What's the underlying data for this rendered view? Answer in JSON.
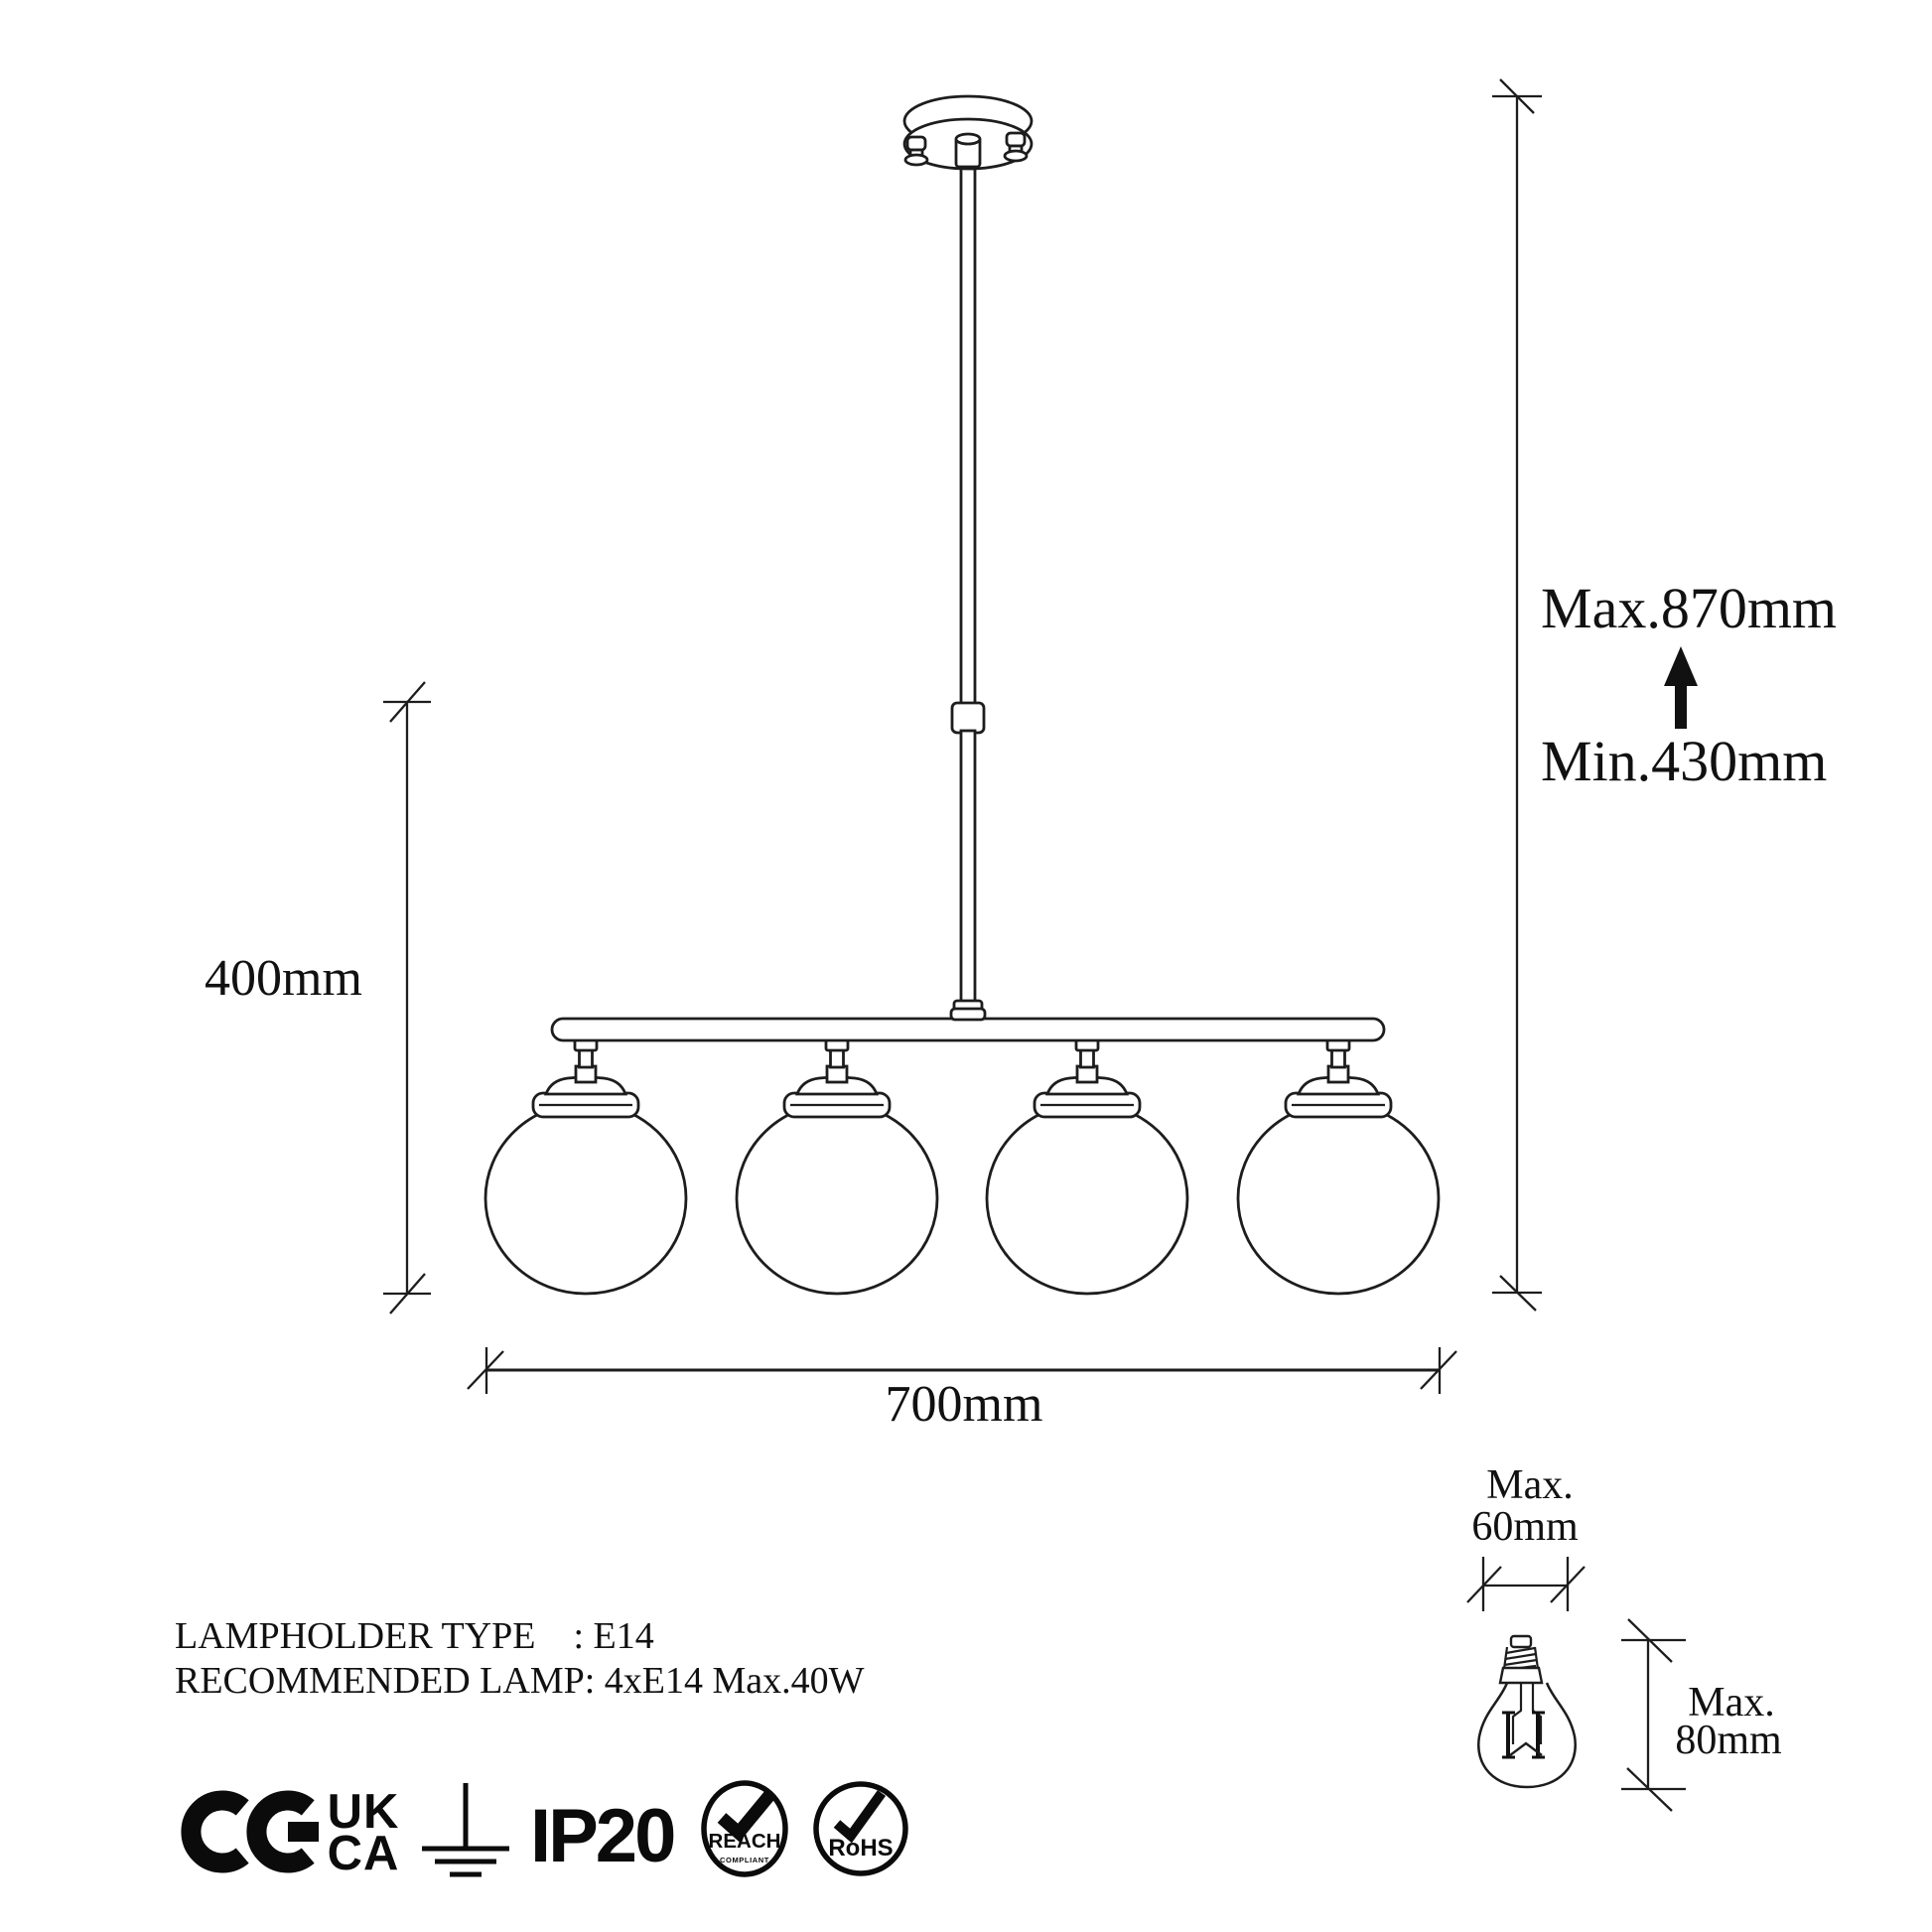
{
  "colors": {
    "line": "#1d1d1d",
    "text": "#111111",
    "background": "#ffffff"
  },
  "dimension_labels": {
    "max_height": "Max.870mm",
    "min_height": "Min.430mm",
    "fixture_drop": "400mm",
    "fixture_width": "700mm",
    "bulb": {
      "width_prefix": "Max.",
      "width": "60mm",
      "height_prefix": "Max.",
      "height": "80mm"
    }
  },
  "spec_lines": {
    "line1": "LAMPHOLDER TYPE    : E14",
    "line2": "RECOMMENDED LAMP: 4xE14 Max.40W"
  },
  "marks": {
    "ukca_top": "UK",
    "ukca_bottom": "CA",
    "ip_rating": "IP20",
    "reach": "REACH",
    "reach_sub": "COMPLIANT",
    "rohs": "RoHS"
  }
}
